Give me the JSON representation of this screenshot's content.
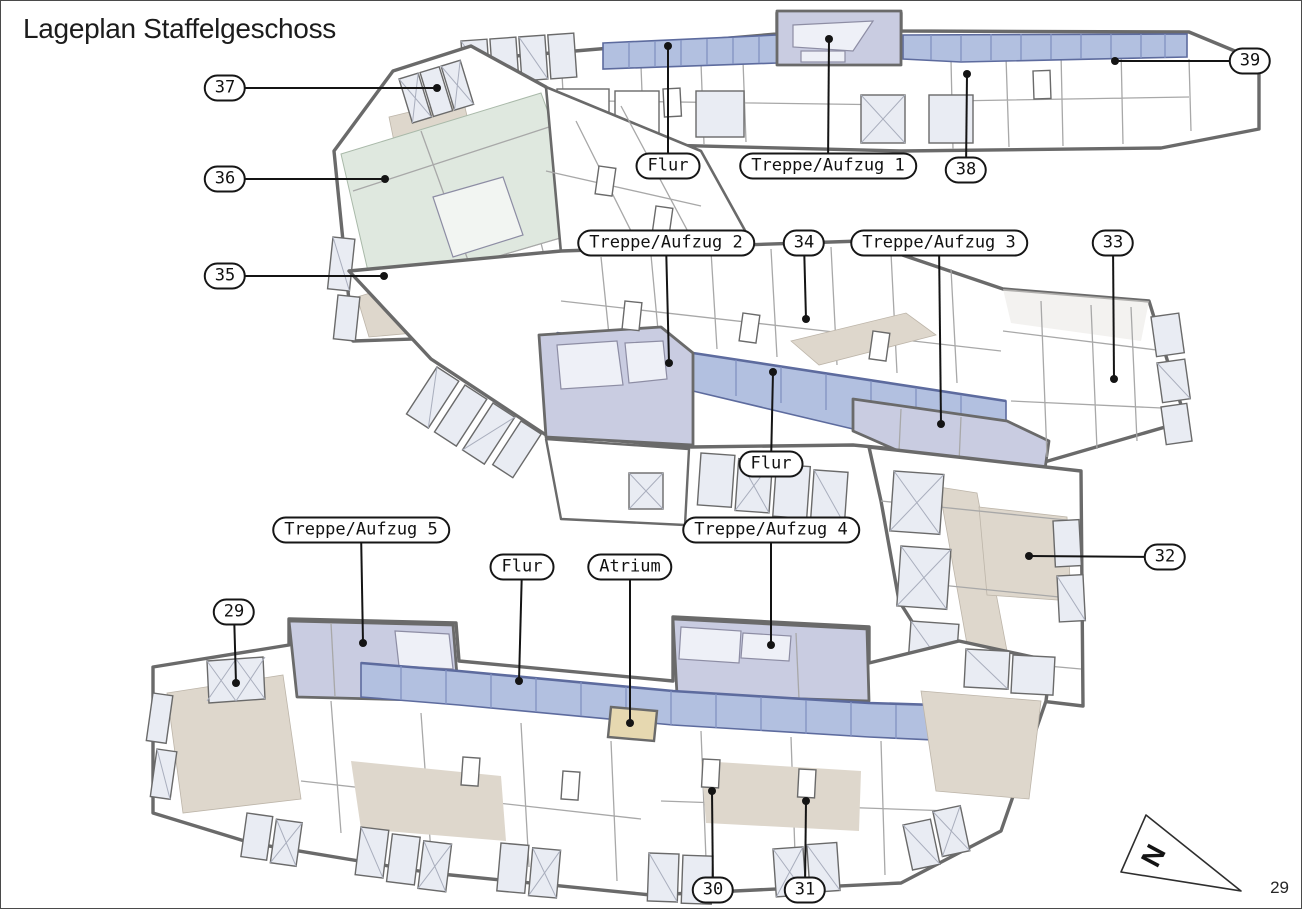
{
  "page": {
    "title": "Lageplan Staffelgeschoss",
    "page_number": "29"
  },
  "north_arrow": {
    "label": "N"
  },
  "colors": {
    "wall": "#6a6a6a",
    "leader": "#141414",
    "corridor_fill": "#b2c0e0",
    "corridor_stroke": "#5d6b9e",
    "corridor_mullion": "#8291c2",
    "stair_fill": "#c9cce1",
    "green_fill": "#dfe8df",
    "beige_fill": "#ded7cc",
    "atrium_fill": "#e6d8b0",
    "window_fill": "#e9ecf3"
  },
  "labels": [
    {
      "id": "unit-37",
      "text": "37",
      "type": "number",
      "cx": 224,
      "cy": 87,
      "tx": 436,
      "ty": 87
    },
    {
      "id": "unit-36",
      "text": "36",
      "type": "number",
      "cx": 224,
      "cy": 178,
      "tx": 384,
      "ty": 178
    },
    {
      "id": "unit-35",
      "text": "35",
      "type": "number",
      "cx": 224,
      "cy": 275,
      "tx": 383,
      "ty": 275
    },
    {
      "id": "corridor-top",
      "text": "Flur",
      "type": "name",
      "cx": 667,
      "cy": 165,
      "tx": 667,
      "ty": 45
    },
    {
      "id": "stair-1",
      "text": "Treppe/Aufzug 1",
      "type": "name",
      "cx": 827,
      "cy": 165,
      "tx": 828,
      "ty": 38
    },
    {
      "id": "unit-38",
      "text": "38",
      "type": "number",
      "cx": 965,
      "cy": 169,
      "tx": 966,
      "ty": 73
    },
    {
      "id": "unit-39",
      "text": "39",
      "type": "number",
      "cx": 1249,
      "cy": 60,
      "tx": 1114,
      "ty": 60
    },
    {
      "id": "stair-2",
      "text": "Treppe/Aufzug 2",
      "type": "name",
      "cx": 665,
      "cy": 242,
      "tx": 668,
      "ty": 362
    },
    {
      "id": "unit-34",
      "text": "34",
      "type": "number",
      "cx": 803,
      "cy": 242,
      "tx": 805,
      "ty": 318
    },
    {
      "id": "stair-3",
      "text": "Treppe/Aufzug 3",
      "type": "name",
      "cx": 938,
      "cy": 242,
      "tx": 940,
      "ty": 423
    },
    {
      "id": "unit-33",
      "text": "33",
      "type": "number",
      "cx": 1112,
      "cy": 242,
      "tx": 1113,
      "ty": 378
    },
    {
      "id": "corridor-mid",
      "text": "Flur",
      "type": "name",
      "cx": 770,
      "cy": 463,
      "tx": 772,
      "ty": 371
    },
    {
      "id": "stair-5",
      "text": "Treppe/Aufzug 5",
      "type": "name",
      "cx": 360,
      "cy": 529,
      "tx": 362,
      "ty": 642
    },
    {
      "id": "corridor-south",
      "text": "Flur",
      "type": "name",
      "cx": 521,
      "cy": 566,
      "tx": 518,
      "ty": 680
    },
    {
      "id": "atrium",
      "text": "Atrium",
      "type": "name",
      "cx": 629,
      "cy": 566,
      "tx": 629,
      "ty": 722
    },
    {
      "id": "stair-4",
      "text": "Treppe/Aufzug 4",
      "type": "name",
      "cx": 770,
      "cy": 529,
      "tx": 770,
      "ty": 644
    },
    {
      "id": "unit-32",
      "text": "32",
      "type": "number",
      "cx": 1164,
      "cy": 556,
      "tx": 1028,
      "ty": 555
    },
    {
      "id": "unit-29",
      "text": "29",
      "type": "number",
      "cx": 233,
      "cy": 611,
      "tx": 235,
      "ty": 682
    },
    {
      "id": "unit-30",
      "text": "30",
      "type": "number",
      "cx": 712,
      "cy": 889,
      "tx": 711,
      "ty": 790
    },
    {
      "id": "unit-31",
      "text": "31",
      "type": "number",
      "cx": 804,
      "cy": 889,
      "tx": 805,
      "ty": 800
    }
  ]
}
